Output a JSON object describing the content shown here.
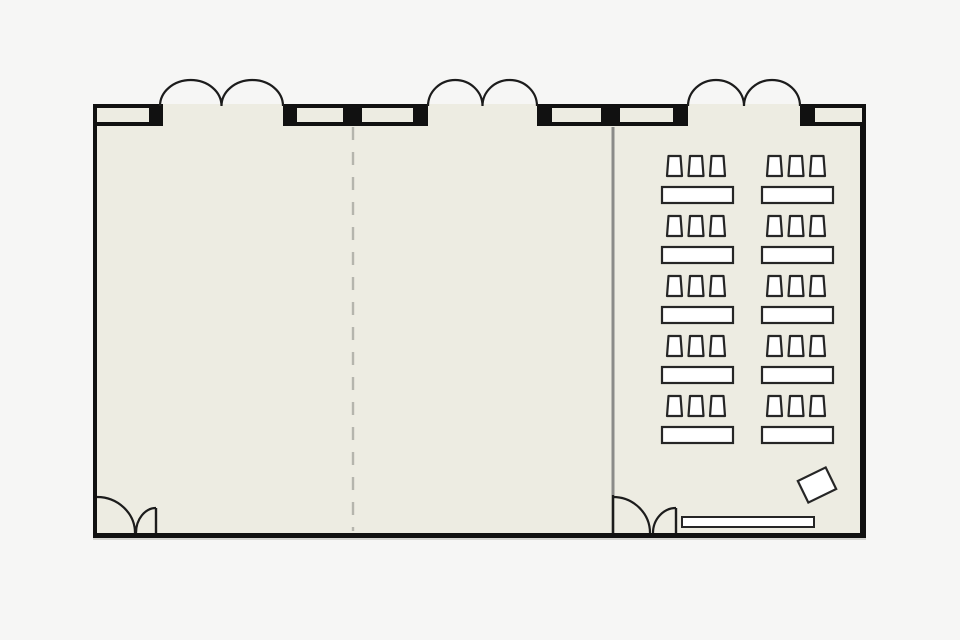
{
  "plan": {
    "kind": "floor-plan",
    "room_label": "event-hall-with-classroom-setup"
  },
  "colors": {
    "canvas_bg": "#f6f6f5",
    "room_fill": "#edece2",
    "wall": "#111111",
    "jamb": "#111111",
    "swing_arc": "#1c1c1c",
    "partition_solid": "#8b8b89",
    "partition_dashed": "#b5b5ad",
    "furniture_fill": "#ffffff",
    "furniture_stroke": "#262626",
    "wall_shadow": "#d5d5d1"
  },
  "room": {
    "x": 93,
    "y": 104,
    "width": 773,
    "height": 434,
    "left_wall_thickness": 4,
    "right_wall_thickness": 6,
    "bottom_wall_thickness": 5
  },
  "walls": {
    "panel_y": 104,
    "panel_height": 22,
    "panel_stroke": 4,
    "panels": [
      {
        "x": 93,
        "width": 60
      },
      {
        "x": 293,
        "width": 54
      },
      {
        "x": 358,
        "width": 59
      },
      {
        "x": 548,
        "width": 57
      },
      {
        "x": 616,
        "width": 61
      },
      {
        "x": 811,
        "width": 55
      }
    ],
    "jambs": [
      {
        "x": 153,
        "width": 10
      },
      {
        "x": 283,
        "width": 10
      },
      {
        "x": 347,
        "width": 11
      },
      {
        "x": 417,
        "width": 11
      },
      {
        "x": 537,
        "width": 11
      },
      {
        "x": 605,
        "width": 11
      },
      {
        "x": 677,
        "width": 11
      },
      {
        "x": 800,
        "width": 11
      }
    ]
  },
  "doors": {
    "arc_height": 26,
    "floor_y": 533,
    "top_double_doors": [
      {
        "from_x": 160,
        "to_x": 283
      },
      {
        "from_x": 428,
        "to_x": 537
      },
      {
        "from_x": 688,
        "to_x": 800
      }
    ],
    "bottom_doors": [
      {
        "jamb_line_x": null,
        "large_arc": {
          "start_x": 97,
          "start_y": 497,
          "floor_x": 135
        },
        "small_leaf": {
          "panel_x": 156,
          "top_y": 508,
          "floor_x": 136
        }
      },
      {
        "jamb_line_x": 613,
        "large_arc": {
          "start_x": 613,
          "start_y": 497,
          "floor_x": 650
        },
        "small_leaf": {
          "panel_x": 676,
          "top_y": 508,
          "floor_x": 653
        }
      }
    ]
  },
  "partitions": {
    "dashed": {
      "x": 353,
      "y1": 127,
      "y2": 531
    },
    "solid": {
      "x": 613,
      "y1": 127,
      "y2": 495
    }
  },
  "furniture": {
    "classroom_seating": {
      "rows": 5,
      "columns": 2,
      "chairs_per_table": 3,
      "total_tables": 10,
      "total_chairs": 30,
      "table_x_by_column": [
        662,
        762
      ],
      "table_first_y": 187,
      "row_pitch": 60,
      "table_width": 71,
      "table_height": 16,
      "chair_offsets_x": [
        5,
        26.5,
        48
      ],
      "chair_row_offset_y": -31,
      "chair_bottom_width": 15,
      "chair_top_width": 12,
      "chair_height": 20
    },
    "lectern": {
      "cx": 817,
      "cy": 485,
      "width": 31,
      "height": 24,
      "rotation_deg": -26
    },
    "head_table": {
      "x": 682,
      "y": 517,
      "width": 132,
      "height": 10
    }
  }
}
